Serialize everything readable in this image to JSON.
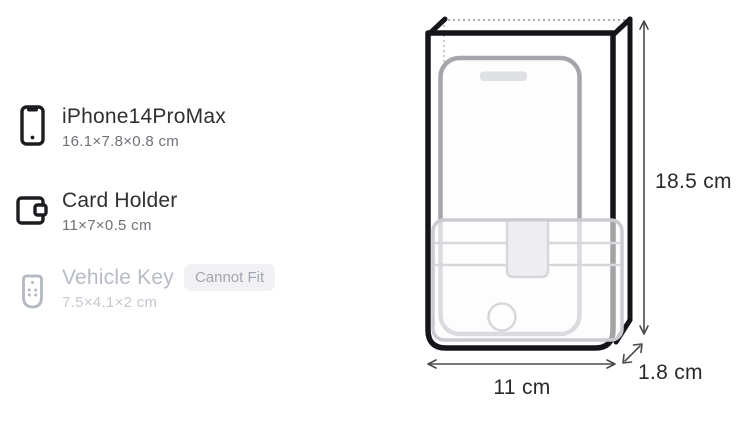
{
  "page": {
    "background": "#ffffff"
  },
  "items": [
    {
      "name": "iPhone14ProMax",
      "dimensions": "16.1×7.8×0.8 cm",
      "icon": "smartphone-icon",
      "status": "fits"
    },
    {
      "name": "Card Holder",
      "dimensions": "11×7×0.5 cm",
      "icon": "card-holder-icon",
      "status": "fits"
    },
    {
      "name": "Vehicle Key",
      "dimensions": "7.5×4.1×2 cm",
      "icon": "key-fob-icon",
      "status": "cannot-fit",
      "badge": "Cannot Fit"
    }
  ],
  "diagram": {
    "height_label": "18.5 cm",
    "width_label": "11 cm",
    "depth_label": "1.8 cm",
    "contents": [
      "smartphone-outline",
      "card-holder-outline"
    ]
  },
  "colors": {
    "case_outline": "#141518",
    "phone_outline": "#a4a6ac",
    "card_outline": "#c9cbd1",
    "title_text": "#2e3033",
    "dims_text": "#6e7177",
    "disabled_text": "#b7bbc5",
    "badge_bg": "#f1f1f4",
    "badge_text": "#a2a6b0",
    "dimension_text": "#28292c"
  }
}
